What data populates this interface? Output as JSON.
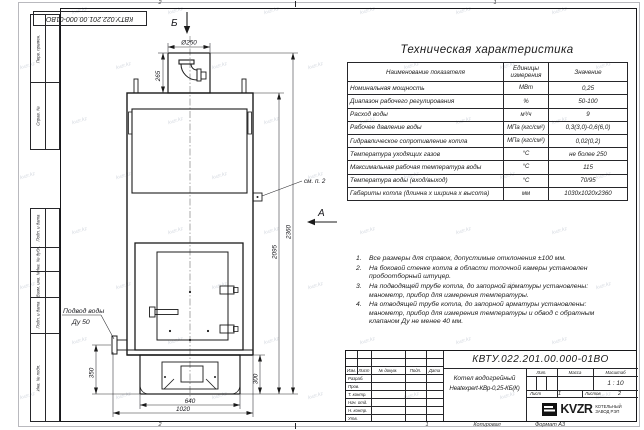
{
  "sheet": {
    "zones_top": [
      "2",
      "1"
    ],
    "zones_bottom": [
      "2",
      "1"
    ],
    "copy_label": "Копировал",
    "format_label": "Формат А3"
  },
  "top_stamp": "КВТУ.022.201.00.000-01ВО",
  "side_columns": {
    "top": [
      "Перв. примен.",
      "Справ. №"
    ],
    "bottom": [
      "Подп. и дата",
      "Инв. № дубл.",
      "Взам. инв. №",
      "Подп. и дата",
      "Инв. № подл."
    ]
  },
  "spec_table": {
    "title": "Техническая характеристика",
    "headers": [
      "Наименование показателя",
      "Единицы измерения",
      "Значение"
    ],
    "rows": [
      {
        "name": "Номинальная мощность",
        "unit": "МВт",
        "value": "0,25"
      },
      {
        "name": "Диапазон рабочего регулирования",
        "unit": "%",
        "value": "50-100"
      },
      {
        "name": "Расход воды",
        "unit": "м³/ч",
        "value": "9"
      },
      {
        "name": "Рабочее давление воды",
        "unit": "МПа (кгс/см²)",
        "value": "0,3(3,0)-0,6(6,0)"
      },
      {
        "name": "Гидравлическое сопротивление котла",
        "unit": "МПа (кгс/см²)",
        "value": "0,02(0,2)"
      },
      {
        "name": "Температура уходящих газов",
        "unit": "°С",
        "value": "не более 250"
      },
      {
        "name": "Максимальная рабочая температура воды",
        "unit": "°С",
        "value": "115"
      },
      {
        "name": "Температура воды (вход/выход)",
        "unit": "°С",
        "value": "70/95"
      },
      {
        "name": "Габариты котла (длинна х ширина х высота)",
        "unit": "мм",
        "value": "1030х1020х2360"
      }
    ]
  },
  "notes": [
    "Все размеры для справок, допустимые отклонения ±100 мм.",
    "На боковой стенке котла в области топочной камеры установлен пробоотборный штуцер.",
    "На подводящей трубе котла, до запорной арматуры установлены: манометр, прибор для измерения температуры.",
    "На отводящей трубе котла, до запорной арматуры установлены: манометр, прибор для измерения температуры и обвод с обратным клапаном Ду не менее 40 мм."
  ],
  "title_block": {
    "doc_number": "КВТУ.022.201.00.000-01ВО",
    "name_line1": "Котел водогрейный",
    "name_line2": "Heatexpert-КВр-0,25-КБ(К)",
    "cols": [
      "Изм.",
      "Лист",
      "№ докум.",
      "Подп.",
      "Дата"
    ],
    "rows": [
      "Разраб.",
      "Пров.",
      "Т. контр.",
      "Нач. отд.",
      "Н. контр.",
      "Утв."
    ],
    "lit_label": "Лит.",
    "mass_label": "Масса",
    "scale_label": "Масштаб",
    "scale_value": "1 : 10",
    "sheet_label": "Лист",
    "sheet_value": "1",
    "sheets_label": "Листов",
    "sheets_value": "2",
    "brand": "KVZR",
    "brand_line1": "КОТЕЛЬНЫЙ",
    "brand_line2": "ЗАВОД РЭП"
  },
  "drawing": {
    "view_top": "Б",
    "view_side": "А",
    "dims": {
      "chimney_d": "Ø250",
      "chimney_h": "265",
      "body_h": "2095",
      "total_h": "2360",
      "left_h": "350",
      "base_h": "300",
      "base_w": "640",
      "body_w": "1020"
    },
    "callouts": {
      "see_note": "см. п. 2",
      "water_line1": "Подвод воды",
      "water_line2": "Ду 50"
    }
  },
  "watermark": {
    "text": "kvzr.kz"
  }
}
